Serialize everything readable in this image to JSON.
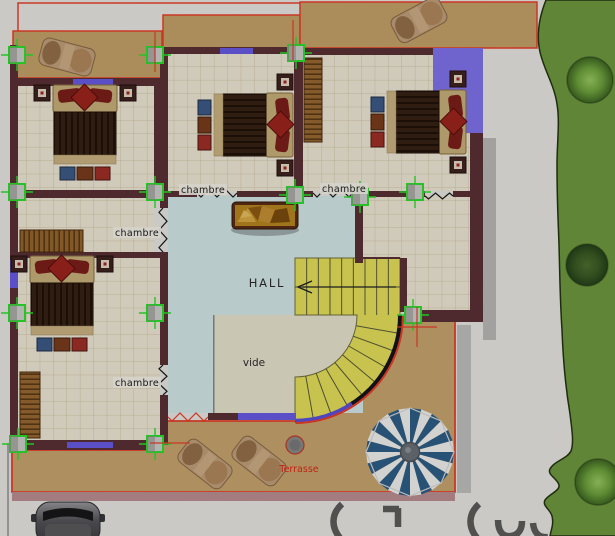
{
  "labels": {
    "room_top_middle": "chambre",
    "room_top_right": "chambre",
    "room_left_middle": "chambre",
    "room_bottom_left": "chambre",
    "hall": "HALL",
    "void": "vide",
    "terrace": "Terrasse"
  },
  "colors": {
    "wall": "#5a3034",
    "window": "#685ce6",
    "window_bay": "#8074ee",
    "tile_floor": "#f1ead8",
    "tile_grid": "#d6c9a9",
    "hall_floor": "#d6e9ea",
    "void_floor": "#eae5d0",
    "stairs": "#e7e15c",
    "balcony": "#c6a26a",
    "terrace": "#c9a76f",
    "terrace_border": "#e8402a",
    "grass": "#6f9a40",
    "marker": "#2de02d",
    "umbrella_blue": "#2f5f88",
    "umbrella_white": "#f3f4f0",
    "label_text": "#1a1a1a",
    "terrace_label": "#e02818",
    "shadow": "#a6a6a6"
  },
  "markers": {
    "positions": [
      [
        17,
        55
      ],
      [
        155,
        55
      ],
      [
        296,
        53
      ],
      [
        17,
        192
      ],
      [
        155,
        192
      ],
      [
        295,
        195
      ],
      [
        360,
        197
      ],
      [
        415,
        192
      ],
      [
        17,
        313
      ],
      [
        155,
        313
      ],
      [
        413,
        315
      ],
      [
        18,
        444
      ],
      [
        155,
        444
      ]
    ],
    "red_crosshairs": [
      [
        155,
        52,
        "v"
      ],
      [
        293,
        40,
        "v"
      ],
      [
        417,
        327,
        "vh"
      ],
      [
        170,
        443,
        "h"
      ]
    ]
  },
  "umbrella": {
    "cx": 410,
    "cy": 452,
    "r": 44,
    "segments": 24
  },
  "stairs": {
    "cx": 295,
    "cy": 315,
    "inner_r": 62,
    "outer_r": 105,
    "flight_top": 258,
    "flight_right": 400,
    "straight_steps": 8,
    "radial_steps": 8
  }
}
